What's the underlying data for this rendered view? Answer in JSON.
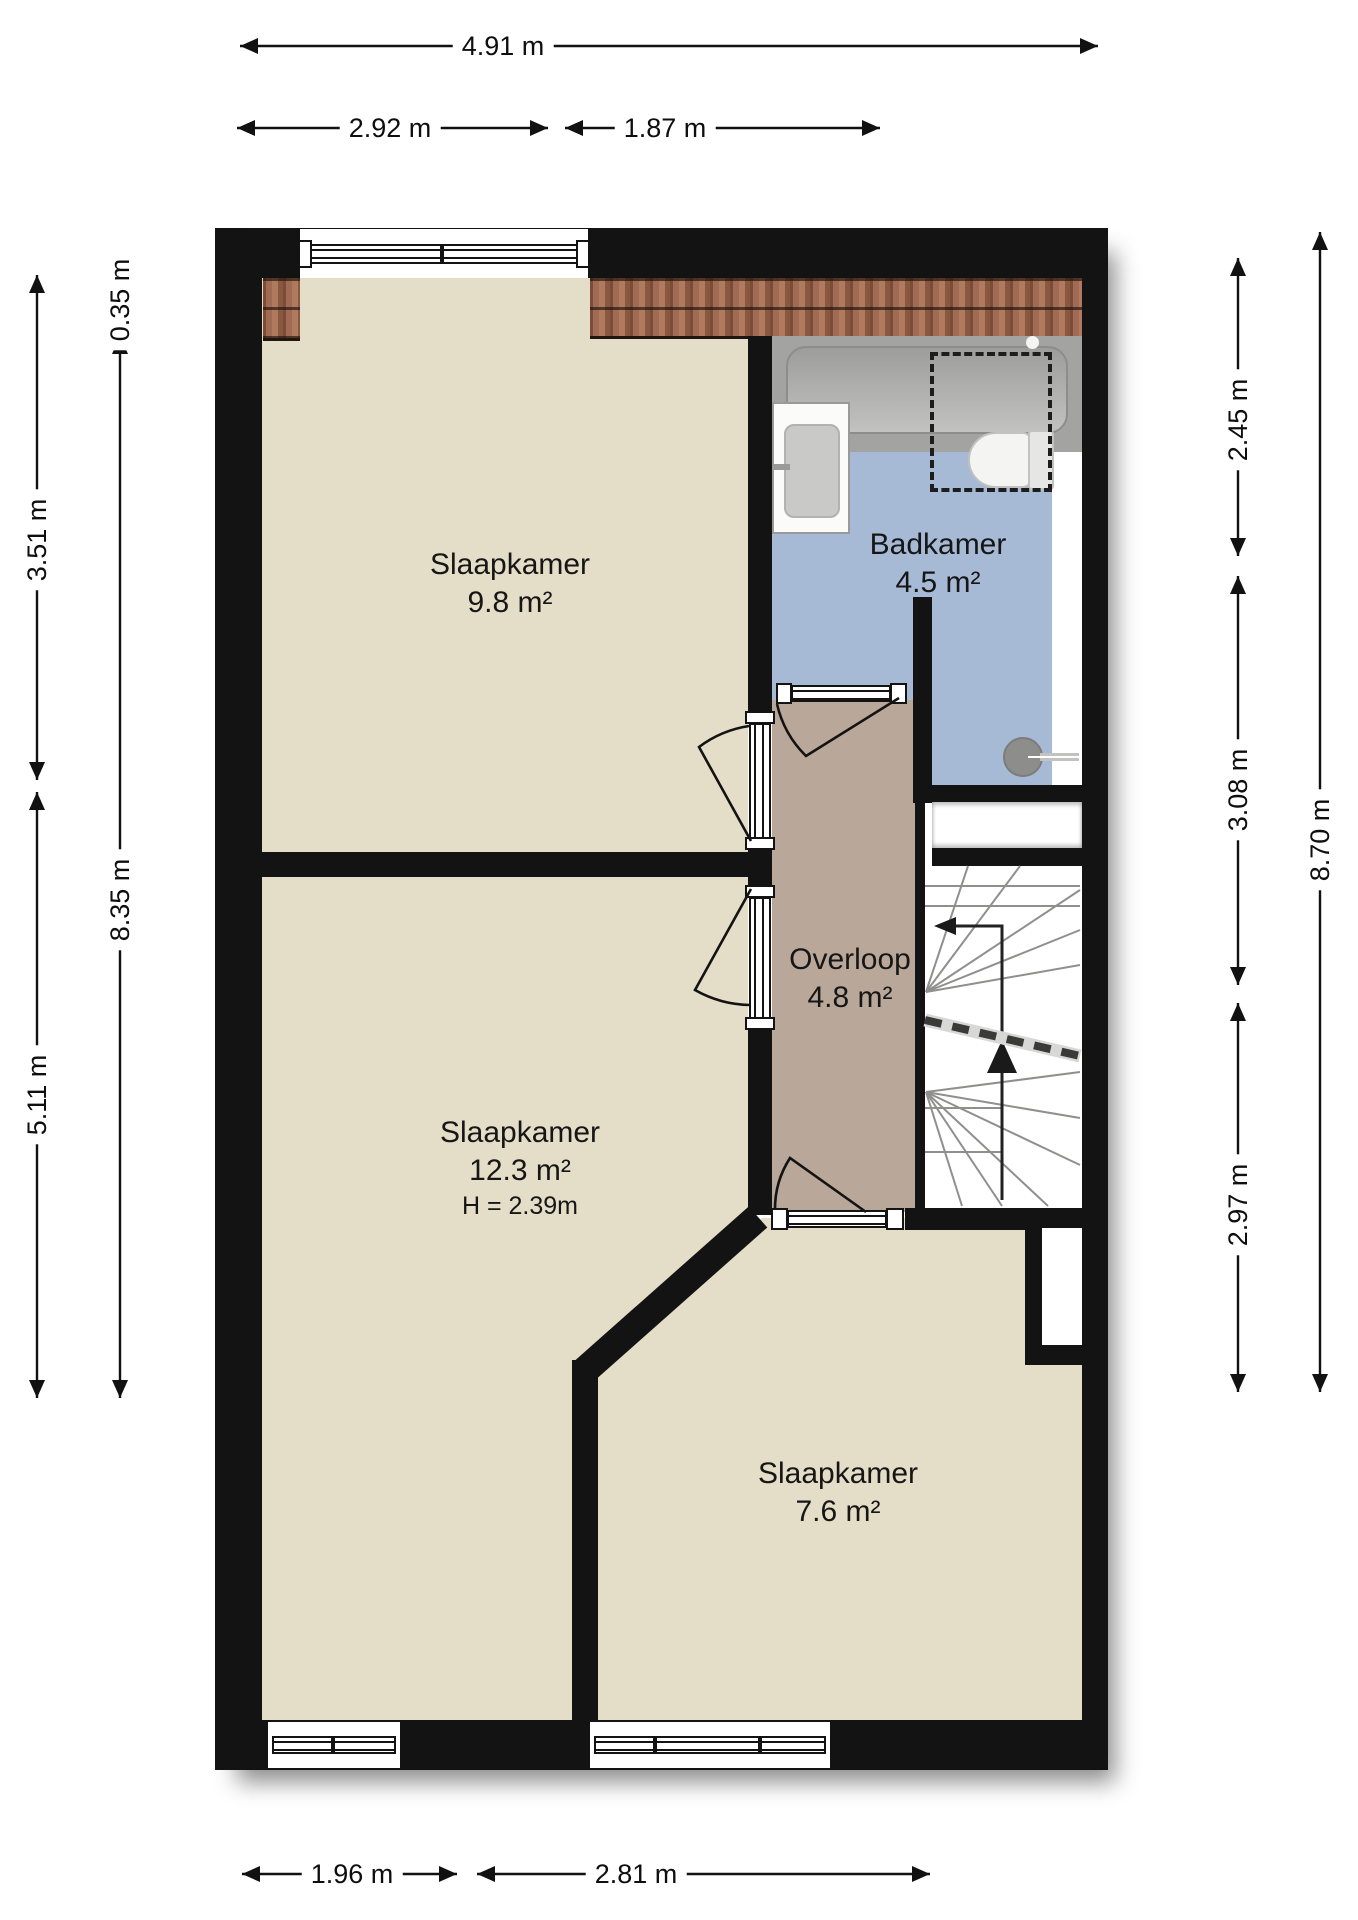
{
  "floorplan": {
    "rooms": [
      {
        "id": "slaapkamer-1",
        "name": "Slaapkamer",
        "area": "9.8 m²"
      },
      {
        "id": "badkamer",
        "name": "Badkamer",
        "area": "4.5 m²"
      },
      {
        "id": "overloop",
        "name": "Overloop",
        "area": "4.8 m²"
      },
      {
        "id": "slaapkamer-2",
        "name": "Slaapkamer",
        "area": "12.3 m²",
        "height": "H = 2.39m"
      },
      {
        "id": "slaapkamer-3",
        "name": "Slaapkamer",
        "area": "7.6 m²"
      }
    ],
    "dimensions": {
      "top": [
        {
          "label": "4.91 m"
        },
        {
          "label": "2.92 m"
        },
        {
          "label": "1.87 m"
        }
      ],
      "left": [
        {
          "label": "0.35 m"
        },
        {
          "label": "3.51 m"
        },
        {
          "label": "8.35 m"
        },
        {
          "label": "5.11 m"
        }
      ],
      "right": [
        {
          "label": "2.45 m"
        },
        {
          "label": "3.08 m"
        },
        {
          "label": "8.70 m"
        },
        {
          "label": "2.97 m"
        }
      ],
      "bottom": [
        {
          "label": "1.96 m"
        },
        {
          "label": "2.81 m"
        }
      ]
    },
    "colors": {
      "wall": "#131313",
      "bedroom_floor": "#e4ddc7",
      "landing_floor": "#b9a899",
      "bathroom_floor": "#a6b9d5",
      "roof_tiles": "#9a6550"
    }
  }
}
